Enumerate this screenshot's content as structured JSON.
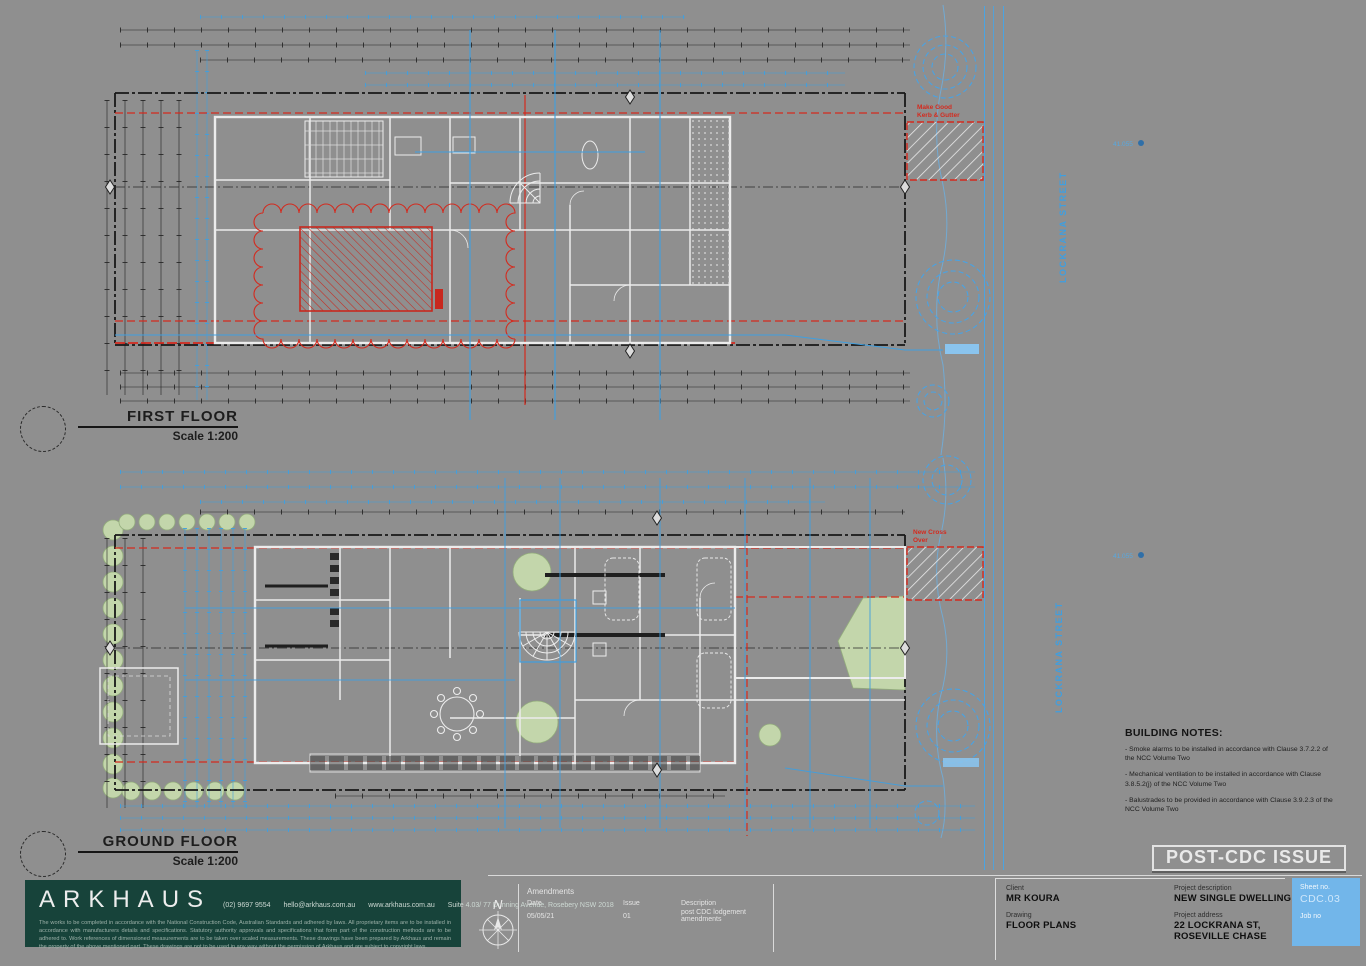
{
  "sheet": {
    "background": "#8f8f8f",
    "colors": {
      "markup_blue": "#3f9fe0",
      "setback_red": "#d42a1e",
      "wall_white": "#ececec",
      "vegetation_green": "#c3d6ab",
      "panel_green": "#17433a",
      "sheetbox_blue": "#72b6ea"
    }
  },
  "plans": {
    "first_floor": {
      "title": "FIRST FLOOR",
      "scale": "Scale 1:200"
    },
    "ground_floor": {
      "title": "GROUND FLOOR",
      "scale": "Scale 1:200"
    }
  },
  "street": {
    "label": "LOCKRANA STREET"
  },
  "levels": {
    "value": "41.055"
  },
  "annotations": {
    "make_good_1": "Make Good",
    "make_good_2": "Kerb & Gutter",
    "new_crossover_1": "New Cross",
    "new_crossover_2": "Over"
  },
  "building_notes": {
    "title": "BUILDING NOTES:",
    "items": [
      "- Smoke alarms to be installed in accordance with Clause 3.7.2.2 of the NCC Volume Two",
      "- Mechanical ventilation to be installed in accordance with Clause 3.8.5.2(j) of the NCC Volume Two",
      "- Balustrades to be provided in accordance with Clause 3.9.2.3 of the NCC Volume Two"
    ]
  },
  "stamp": {
    "label": "POST-CDC ISSUE"
  },
  "title_block": {
    "firm": {
      "name": "ARKHAUS",
      "phone": "(02) 9697 9554",
      "email": "hello@arkhaus.com.au",
      "website": "www.arkhaus.com.au",
      "address": "Suite 4.03/ 77 Dunning Avenue, Rosebery NSW 2018",
      "disclaimer": "The works to be completed in accordance with the National Construction Code, Australian Standards and adhered by laws. All proprietary items are to be installed in accordance with manufacturers details and specifications. Statutory authority approvals and specifications that form part of the construction methods are to be adhered to. Work references of dimensioned measurements are to be taken over scaled measurements. These drawings have been prepared by Arkhaus and remain the property of the above mentioned part. These drawings are not to be used in any way without the permission of Arkhaus and are subject to copyright laws."
    },
    "north": "N",
    "amendments": {
      "title": "Amendments",
      "col_date": "Date",
      "col_issue": "Issue",
      "col_description": "Description",
      "rows": [
        {
          "date": "05/05/21",
          "issue": "01",
          "description": "post CDC lodgement amendments"
        }
      ]
    },
    "client_label": "Client",
    "client": "MR KOURA",
    "drawing_label": "Drawing",
    "drawing": "FLOOR PLANS",
    "project_description_label": "Project description",
    "project_description": "NEW SINGLE DWELLING",
    "project_address_label": "Project address",
    "project_address_line1": "22 LOCKRANA ST,",
    "project_address_line2": "ROSEVILLE CHASE",
    "sheet_no_label": "Sheet no.",
    "sheet_no": "CDC.03",
    "job_no_label": "Job no"
  }
}
